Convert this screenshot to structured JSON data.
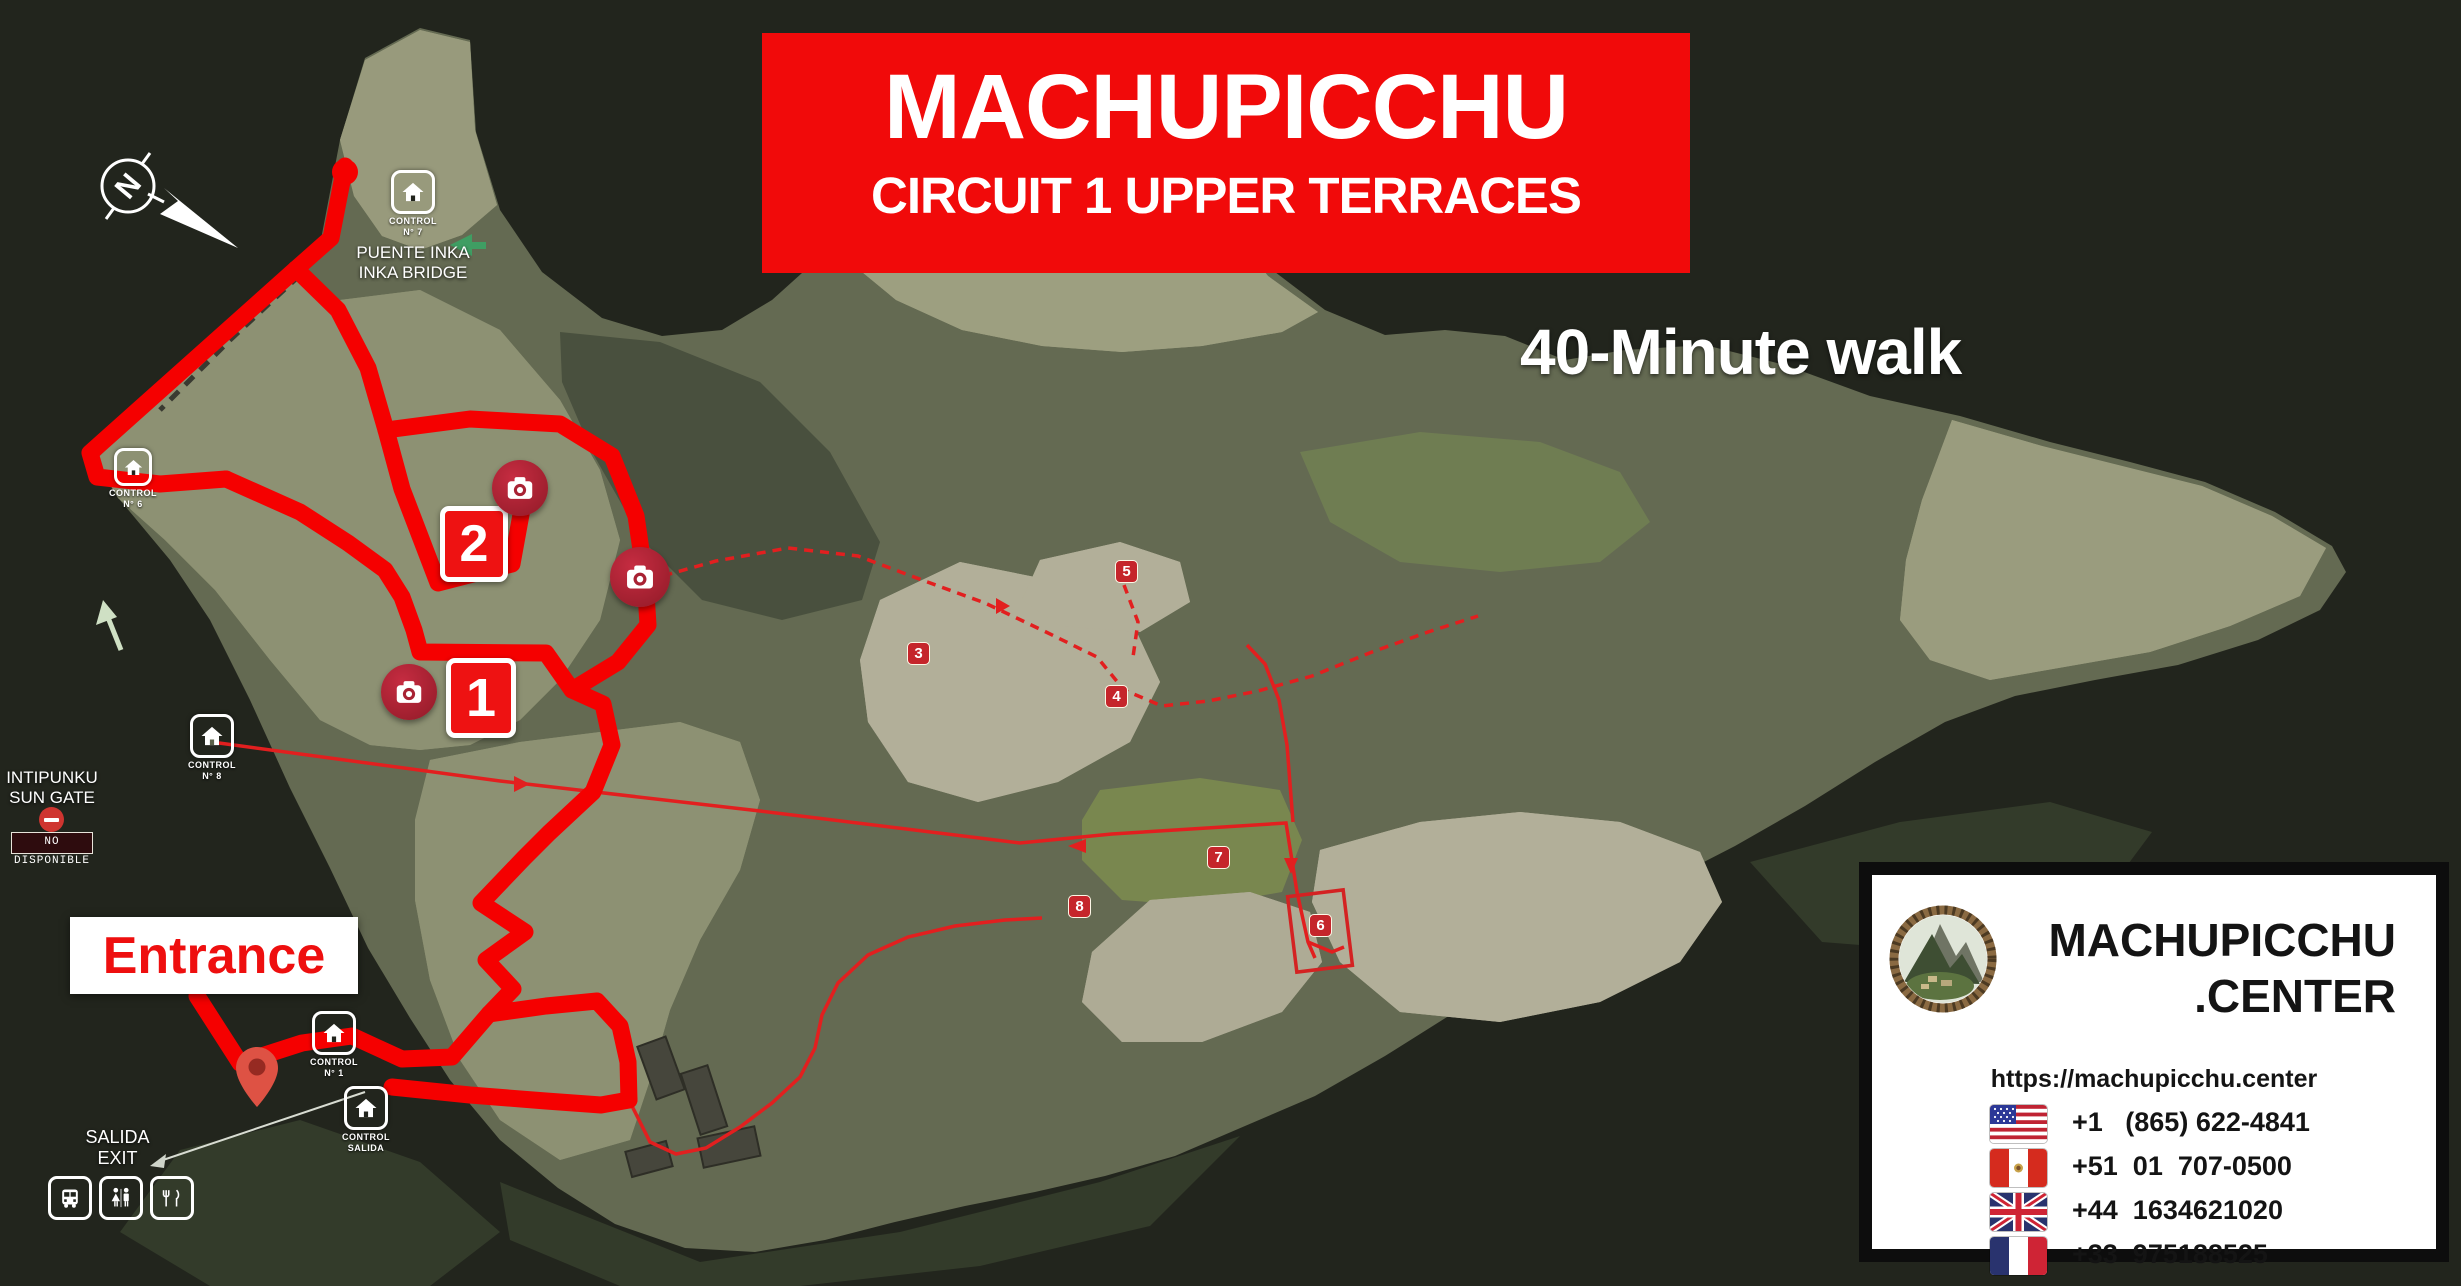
{
  "banner": {
    "title": "MACHUPICCHU",
    "subtitle": "CIRCUIT 1 UPPER TERRACES"
  },
  "walk_note": "40-Minute walk",
  "compass": {
    "letter": "N"
  },
  "pois": {
    "puente_inka": {
      "control_line1": "CONTROL",
      "control_line2": "N° 7",
      "name_line1": "PUENTE INKA",
      "name_line2": "INKA BRIDGE"
    },
    "control_sungate": {
      "control_line1": "CONTROL",
      "control_line2": "N° 6"
    },
    "control_mid": {
      "control_line1": "CONTROL",
      "control_line2": "N° 8"
    },
    "control_entrance": {
      "control_line1": "CONTROL",
      "control_line2": "N° 1"
    },
    "control_exit": {
      "control_line1": "CONTROL",
      "control_line2": "SALIDA"
    },
    "intipunku": {
      "name_line1": "INTIPUNKU",
      "name_line2": "SUN GATE",
      "status_badge": "NO DISPONIBLE"
    },
    "entrance": {
      "label": "Entrance"
    },
    "salida": {
      "name_line1": "SALIDA",
      "name_line2": "EXIT"
    }
  },
  "route": {
    "color_thick": "#f50000",
    "color_thin": "#e21f1f",
    "stops_big": [
      "1",
      "2"
    ],
    "stops_small": [
      "3",
      "4",
      "5",
      "6",
      "7",
      "8"
    ]
  },
  "brand": {
    "line1": "MACHUPICCHU",
    "line2": ".CENTER",
    "url": "https://machupicchu.center",
    "phones": [
      {
        "flag": "usa-flag",
        "number": "+1   (865) 622-4841"
      },
      {
        "flag": "peru-flag",
        "number": "+51  01  707-0500"
      },
      {
        "flag": "uk-flag",
        "number": "+44  1634621020"
      },
      {
        "flag": "france-flag",
        "number": "+33  975188525"
      }
    ]
  }
}
